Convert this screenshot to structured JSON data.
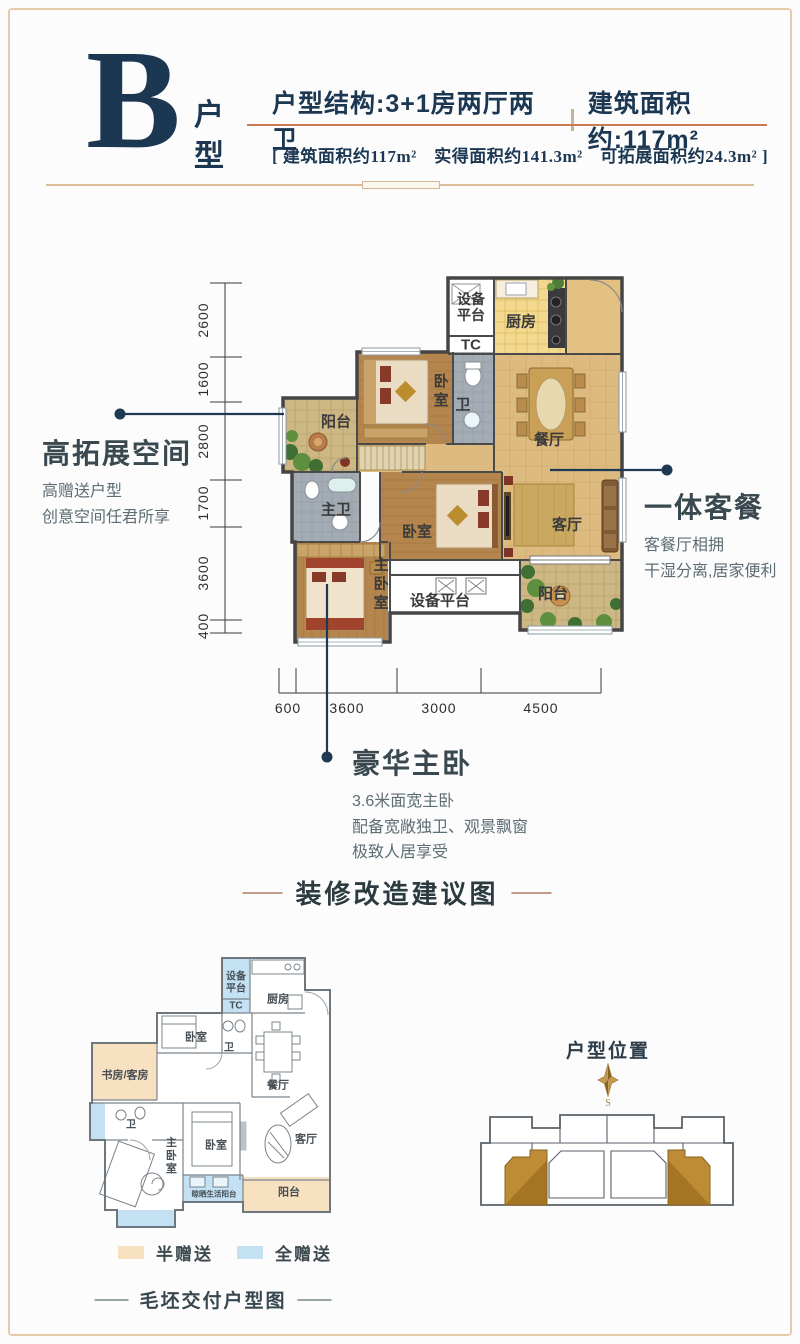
{
  "header": {
    "unit_letter": "B",
    "unit_type_label": "户\n型",
    "structure": "户型结构:3+1房两厅两卫",
    "area": "建筑面积约:117m²",
    "detail_line": "[ 建筑面积约117m²　实得面积约141.3m²　可拓展面积约24.3m² ]"
  },
  "callouts": {
    "expand": {
      "title": "高拓展空间",
      "desc": "高赠送户型\n创意空间任君所享"
    },
    "living_dining": {
      "title": "一体客餐",
      "desc": "客餐厅相拥\n干湿分离,居家便利"
    },
    "master": {
      "title": "豪华主卧",
      "desc": "3.6米面宽主卧\n配备宽敞独卫、观景飘窗\n极致人居享受"
    }
  },
  "main_plan": {
    "rooms": {
      "equipment_platform": "设备\n平台",
      "equipment_platform_h": "设备平台",
      "tc": "TC",
      "kitchen": "厨房",
      "bedroom": "卧室",
      "bath": "卫",
      "dining": "餐厅",
      "balcony": "阳台",
      "master_bath": "主卫",
      "living": "客厅",
      "master_bedroom": "主卧室"
    },
    "dims_left": [
      "2600",
      "1600",
      "2800",
      "1700",
      "3600",
      "400"
    ],
    "dims_bottom": [
      "600",
      "3600",
      "3000",
      "4500"
    ]
  },
  "renovation": {
    "section_title": "装修改造建议图",
    "footer_title": "毛坯交付户型图",
    "rooms": {
      "equipment_platform": "设备\n平台",
      "tc": "TC",
      "kitchen": "厨房",
      "bedroom": "卧室",
      "bath": "卫",
      "dining": "餐厅",
      "study": "书房/客房",
      "master_bedroom": "主卧室",
      "living": "客厅",
      "laundry": "晾晒生活阳台",
      "balcony": "阳台"
    },
    "legend": [
      {
        "label": "半赠送",
        "color": "#f7e1c0"
      },
      {
        "label": "全赠送",
        "color": "#c3e1f3"
      }
    ]
  },
  "location": {
    "title": "户型位置",
    "compass_label": "S"
  },
  "colors": {
    "navy": "#1b3751",
    "salmon": "#c87a55",
    "frame_tan": "#e6cbaa",
    "gold_unit": "#bd8c35",
    "gift_half": "#f7e1c0",
    "gift_full": "#c3e1f3"
  }
}
